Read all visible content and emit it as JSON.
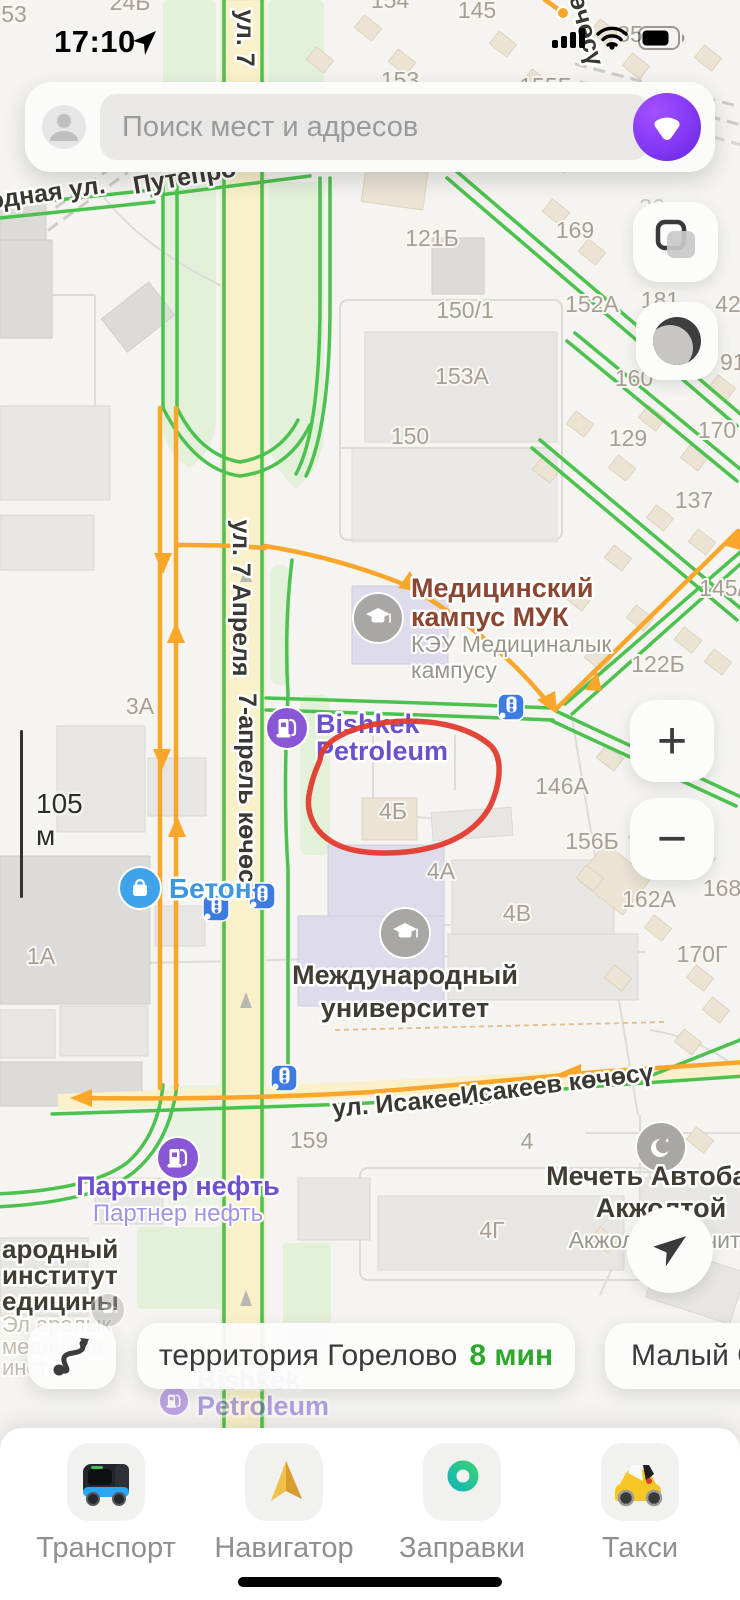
{
  "status_bar": {
    "time": "17:10",
    "location_icon": "navigation-arrow",
    "signal_icon": "cellular-signal",
    "wifi_icon": "wifi",
    "battery_icon": "battery"
  },
  "search": {
    "placeholder": "Поиск мест и адресов",
    "avatar_icon": "profile-avatar",
    "assistant_icon": "alice-assistant"
  },
  "map_controls": {
    "zoom_in": "+",
    "zoom_out": "−",
    "layers_icon": "map-layers",
    "traffic_icon": "road-events",
    "locate_icon": "my-location"
  },
  "scale": {
    "label": "105 м"
  },
  "map": {
    "annotation": {
      "type": "hand-drawn-ellipse",
      "color": "#E23B2E"
    },
    "number_labels": [
      {
        "t": "53",
        "x": 14,
        "y": 22
      },
      {
        "t": "24Б",
        "x": 130,
        "y": 10
      },
      {
        "t": "154",
        "x": 390,
        "y": 8
      },
      {
        "t": "145",
        "x": 477,
        "y": 18
      },
      {
        "t": "153",
        "x": 400,
        "y": 88
      },
      {
        "t": "155Б",
        "x": 546,
        "y": 94
      },
      {
        "t": "35",
        "x": 630,
        "y": 42
      },
      {
        "t": "121Б",
        "x": 432,
        "y": 246
      },
      {
        "t": "169",
        "x": 575,
        "y": 238
      },
      {
        "t": "36",
        "x": 652,
        "y": 215,
        "f": 1
      },
      {
        "t": "150/1",
        "x": 465,
        "y": 318
      },
      {
        "t": "152А",
        "x": 592,
        "y": 312
      },
      {
        "t": "181",
        "x": 660,
        "y": 308
      },
      {
        "t": "42",
        "x": 728,
        "y": 312
      },
      {
        "t": "153А",
        "x": 462,
        "y": 384
      },
      {
        "t": "160",
        "x": 634,
        "y": 386
      },
      {
        "t": "91/",
        "x": 736,
        "y": 370
      },
      {
        "t": "150",
        "x": 410,
        "y": 444
      },
      {
        "t": "129",
        "x": 628,
        "y": 446
      },
      {
        "t": "170",
        "x": 717,
        "y": 438
      },
      {
        "t": "137",
        "x": 694,
        "y": 508
      },
      {
        "t": "145/2",
        "x": 728,
        "y": 596
      },
      {
        "t": "122Б",
        "x": 658,
        "y": 672
      },
      {
        "t": "3А",
        "x": 140,
        "y": 714
      },
      {
        "t": "173",
        "x": 672,
        "y": 769,
        "f": 1
      },
      {
        "t": "146А",
        "x": 562,
        "y": 794
      },
      {
        "t": "4Б",
        "x": 393,
        "y": 819
      },
      {
        "t": "156Б",
        "x": 592,
        "y": 849
      },
      {
        "t": "4А",
        "x": 441,
        "y": 879
      },
      {
        "t": "162А",
        "x": 649,
        "y": 907
      },
      {
        "t": "168",
        "x": 722,
        "y": 896
      },
      {
        "t": "1А",
        "x": 41,
        "y": 964
      },
      {
        "t": "4В",
        "x": 517,
        "y": 921
      },
      {
        "t": "170Г",
        "x": 702,
        "y": 962
      },
      {
        "t": "159",
        "x": 309,
        "y": 1148
      },
      {
        "t": "4",
        "x": 527,
        "y": 1149
      },
      {
        "t": "4Г",
        "x": 492,
        "y": 1238
      }
    ],
    "street_labels": [
      {
        "t": "одная ул.",
        "x": 48,
        "y": 201,
        "r": -8
      },
      {
        "t": "Путепро",
        "x": 186,
        "y": 185,
        "r": -10
      },
      {
        "t": "ул. 7",
        "x": 237,
        "y": 38,
        "r": 90
      },
      {
        "t": "көчөсү",
        "x": 577,
        "y": 26,
        "r": 75
      },
      {
        "t": "ул. 7 Апреля",
        "x": 233,
        "y": 598,
        "r": 90
      },
      {
        "t": "7-апрель көчөсү",
        "x": 239,
        "y": 795,
        "r": 90
      },
      {
        "t": "ул. Исакеева",
        "x": 412,
        "y": 1110,
        "r": -5
      },
      {
        "t": "Исакеев көчөсү",
        "x": 558,
        "y": 1092,
        "r": -7
      }
    ],
    "pois": [
      {
        "kind": "fuel",
        "x": 287,
        "y": 728,
        "r": 21,
        "title": [
          "Bishkek",
          "Petroleum"
        ],
        "style": "purple",
        "tpos": "right",
        "tdy": 5,
        "lh": 27
      },
      {
        "kind": "edu",
        "x": 378,
        "y": 618,
        "r": 25,
        "title": [
          "Медицинский",
          "кампус МУК"
        ],
        "style": "maroon",
        "sub": [
          "КЭУ Медициналык",
          "кампусу"
        ],
        "tpos": "right",
        "tdy": -21,
        "lh": 29,
        "slh": 26
      },
      {
        "kind": "shop",
        "x": 140,
        "y": 888,
        "r": 21,
        "title": [
          "Бетон"
        ],
        "style": "blue",
        "tpos": "right",
        "tdy": 10,
        "lh": 28
      },
      {
        "kind": "edu",
        "x": 405,
        "y": 933,
        "r": 25,
        "title": [
          "Международный",
          "университет"
        ],
        "style": "dark",
        "tpos": "below",
        "tdy": 51,
        "lh": 33
      },
      {
        "kind": "mosque",
        "x": 661,
        "y": 1147,
        "r": 25,
        "title": [
          "Мечеть Автобаза",
          "Акжолтой"
        ],
        "style": "dark",
        "sub": [
          "Акжолтой мечити"
        ],
        "tpos": "below",
        "tdy": 38,
        "lh": 32,
        "slh": 31
      },
      {
        "kind": "fuel",
        "x": 178,
        "y": 1158,
        "r": 21,
        "title": [
          "Партнер нефть"
        ],
        "style": "purple",
        "sub": [
          "Партнер нефть"
        ],
        "sstyle": "purple-light",
        "tpos": "below",
        "tdy": 37,
        "lh": 27,
        "slh": 26
      },
      {
        "kind": "edu",
        "x": 108,
        "y": 1310,
        "r": 17,
        "opacity": 0.45
      },
      {
        "kind": "fuel",
        "x": 174,
        "y": 1401,
        "r": 15,
        "opacity": 0.5,
        "title": [
          "Bishkek",
          "Petroleum"
        ],
        "style": "purple",
        "tpos": "right",
        "tdy": -12,
        "lh": 26
      }
    ],
    "traffic_lights": [
      [
        511,
        707
      ],
      [
        216,
        908
      ],
      [
        262,
        896
      ],
      [
        284,
        1078
      ]
    ],
    "left_text_block": {
      "dark": [
        {
          "t": "ародный",
          "y": 1258
        },
        {
          "t": "институт",
          "y": 1284
        },
        {
          "t": "едицины",
          "y": 1310
        }
      ],
      "faded": [
        {
          "t": "Эл аралык",
          "y": 1332
        },
        {
          "t": "медицина",
          "y": 1354
        },
        {
          "t": "инсти",
          "y": 1375
        }
      ]
    }
  },
  "bottom_cards": {
    "route_icon": "route-curve",
    "cards": [
      {
        "name": "территория Горелово",
        "eta": "8 мин"
      },
      {
        "name": "Малый С",
        "eta": ""
      }
    ]
  },
  "app_bar": {
    "items": [
      {
        "label": "Транспорт",
        "icon": "bus"
      },
      {
        "label": "Навигатор",
        "icon": "nav-arrow"
      },
      {
        "label": "Заправки",
        "icon": "fuel-pump"
      },
      {
        "label": "Такси",
        "icon": "taxi-car"
      }
    ]
  },
  "colors": {
    "traffic_green": "#4CC24E",
    "traffic_orange": "#F9A62B",
    "eta_green": "#2DA82C",
    "annotation_red": "#E23B2E",
    "poi_purple": "#6C50CE",
    "alice_purple": "#8438F5",
    "traffic_light_blue": "#3D7BE3"
  }
}
